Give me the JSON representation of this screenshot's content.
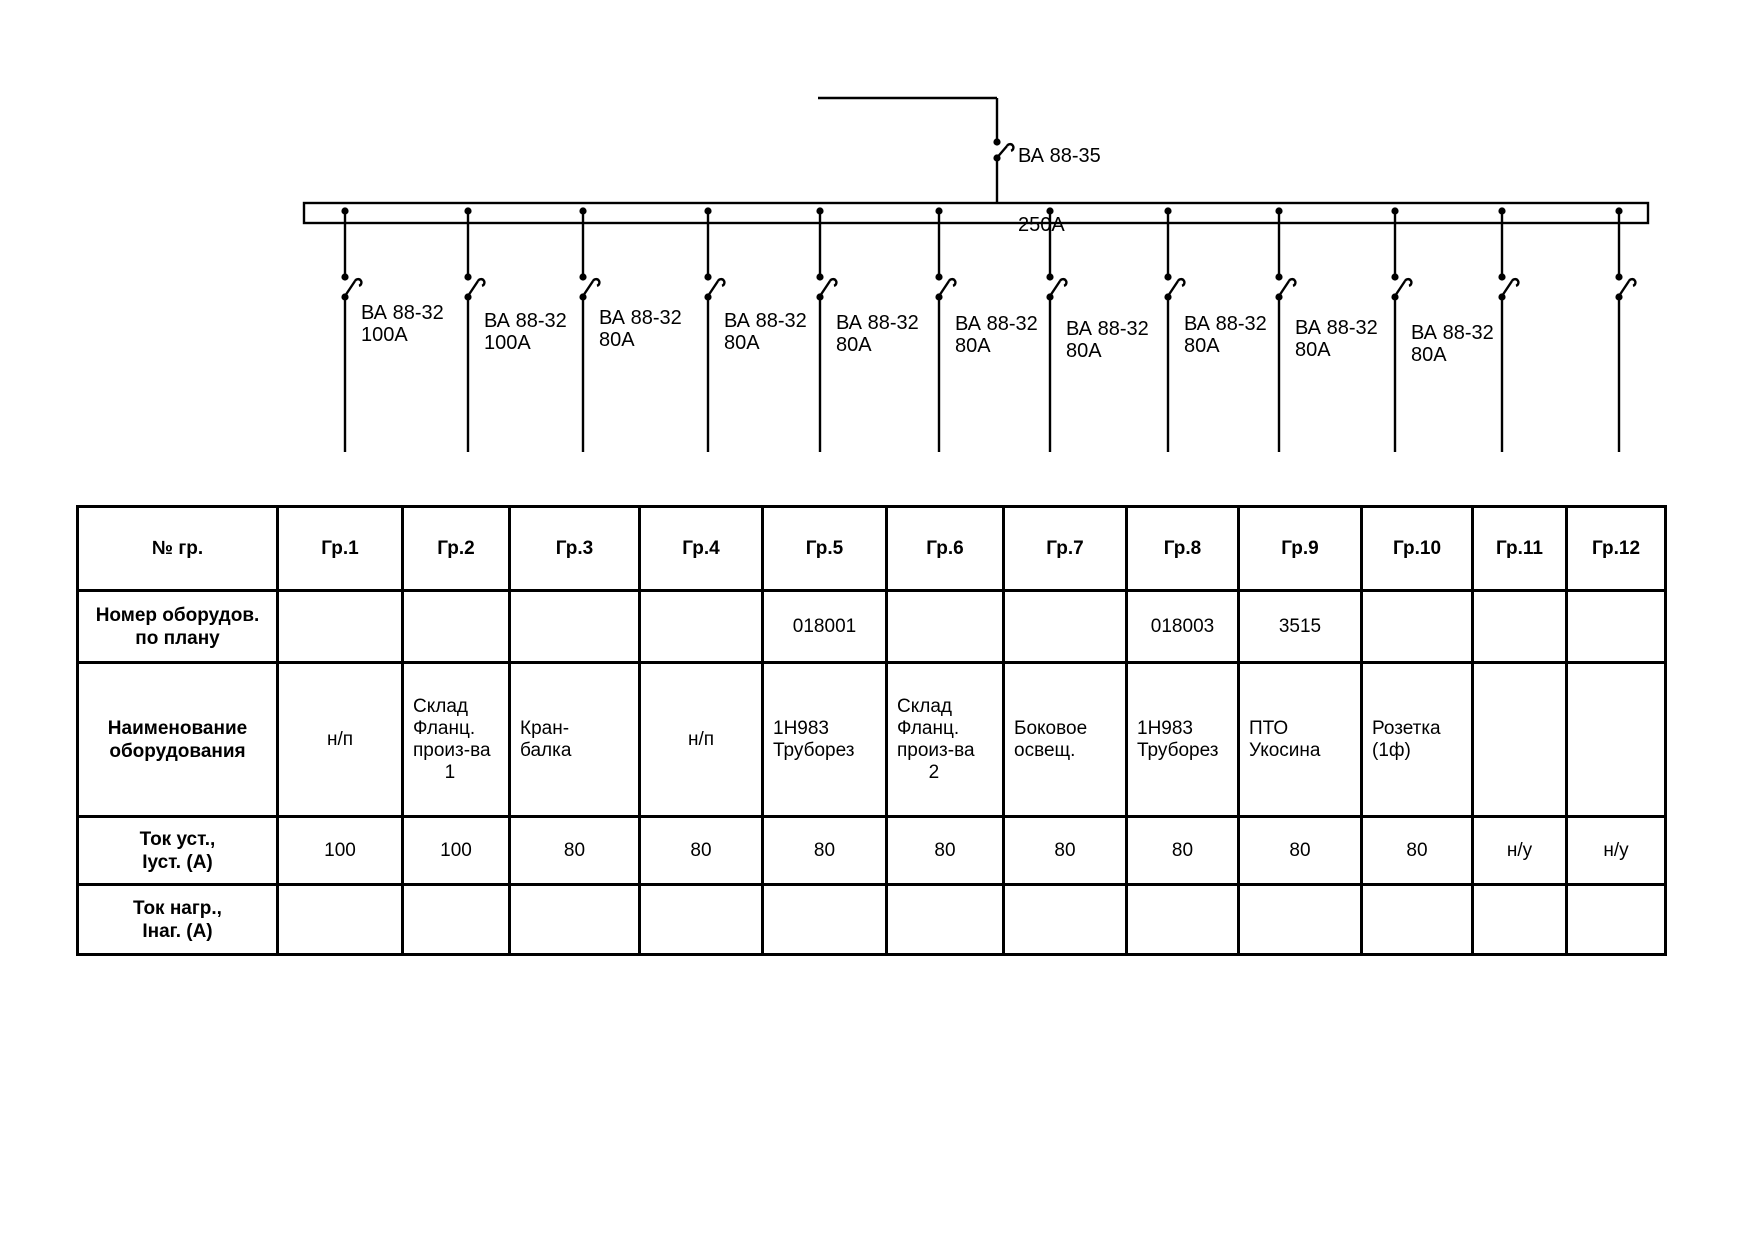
{
  "diagram": {
    "main_breaker": {
      "label_line1": "ВА 88-35",
      "label_line2": "250А"
    },
    "feeders": [
      {
        "group": "Гр.1",
        "label_line1": "ВА 88-32",
        "label_line2": "100А"
      },
      {
        "group": "Гр.2",
        "label_line1": "ВА 88-32",
        "label_line2": "100А"
      },
      {
        "group": "Гр.3",
        "label_line1": "ВА 88-32",
        "label_line2": "80А"
      },
      {
        "group": "Гр.4",
        "label_line1": "ВА 88-32",
        "label_line2": "80А"
      },
      {
        "group": "Гр.5",
        "label_line1": "ВА 88-32",
        "label_line2": "80А"
      },
      {
        "group": "Гр.6",
        "label_line1": "ВА 88-32",
        "label_line2": "80А"
      },
      {
        "group": "Гр.7",
        "label_line1": "ВА 88-32",
        "label_line2": "80А"
      },
      {
        "group": "Гр.8",
        "label_line1": "ВА 88-32",
        "label_line2": "80А"
      },
      {
        "group": "Гр.9",
        "label_line1": "ВА 88-32",
        "label_line2": "80А"
      },
      {
        "group": "Гр.10",
        "label_line1": "ВА 88-32",
        "label_line2": "80А"
      },
      {
        "group": "Гр.11",
        "label_line1": null,
        "label_line2": null
      },
      {
        "group": "Гр.12",
        "label_line1": null,
        "label_line2": null
      }
    ]
  },
  "table": {
    "header_label": "№ гр.",
    "group_headers": [
      "Гр.1",
      "Гр.2",
      "Гр.3",
      "Гр.4",
      "Гр.5",
      "Гр.6",
      "Гр.7",
      "Гр.8",
      "Гр.9",
      "Гр.10",
      "Гр.11",
      "Гр.12"
    ],
    "rows": [
      {
        "label": "Номер оборудов.\nпо плану",
        "cells": [
          "",
          "",
          "",
          "",
          "018001",
          "",
          "",
          "018003",
          "3515",
          "",
          "",
          ""
        ]
      },
      {
        "label": "Наименование\nоборудования",
        "cells": [
          "н/п",
          "Склад\nФланц.\nпроиз-ва\n      1",
          "Кран-\nбалка",
          "н/п",
          "1Н983\nТруборез",
          "Склад\nФланц.\nпроиз-ва\n      2",
          "Боковое\nосвещ.",
          "1Н983\nТруборез",
          "ПТО\nУкосина",
          "Розетка\n(1ф)",
          "",
          ""
        ]
      },
      {
        "label": "Ток уст.,\nIуст. (А)",
        "cells": [
          "100",
          "100",
          "80",
          "80",
          "80",
          "80",
          "80",
          "80",
          "80",
          "80",
          "н/у",
          "н/у"
        ]
      },
      {
        "label": "Ток нагр.,\nIнаг. (А)",
        "cells": [
          "",
          "",
          "",
          "",
          "",
          "",
          "",
          "",
          "",
          "",
          "",
          ""
        ]
      }
    ]
  }
}
